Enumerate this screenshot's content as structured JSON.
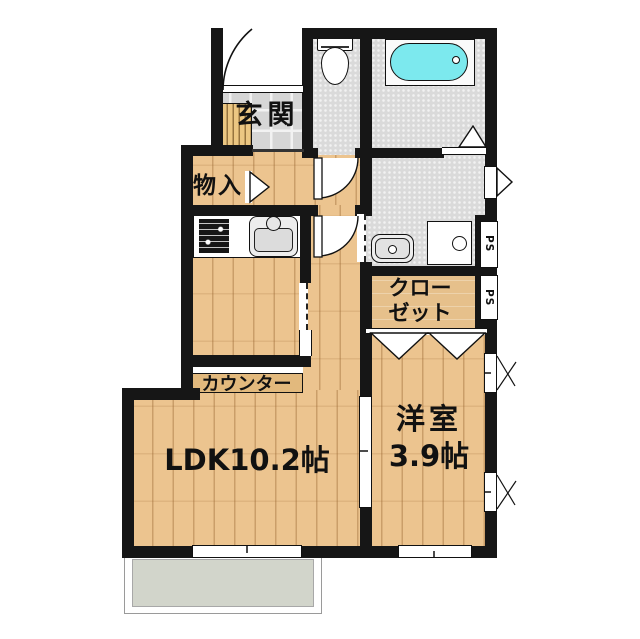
{
  "labels": {
    "genkan": "玄関",
    "monoire": "物入",
    "closet_line1": "クロー",
    "closet_line2": "ゼット",
    "ldk": "LDK10.2帖",
    "yoshitsu_line1": "洋室",
    "yoshitsu_line2": "3.9帖",
    "counter": "カウンター",
    "ps": "PS",
    "ps_right_top": "PS",
    "ps_right_bottom": "PS"
  },
  "rooms": [
    {
      "name": "LDK",
      "size": "10.2帖"
    },
    {
      "name": "洋室",
      "size": "3.9帖"
    },
    {
      "name": "玄関"
    },
    {
      "name": "物入"
    },
    {
      "name": "クローゼット"
    }
  ],
  "colors": {
    "wall": "#161616",
    "wood_floor": "#ecc48f",
    "tile_floor": "#d6d6d6",
    "wet_area_floor": "#dadada",
    "bathtub_water": "#7ce9ee",
    "balcony": "#d2d5cb",
    "counter_bar": "#e2b97d"
  },
  "icons": {
    "bathtub": "bathtub-icon",
    "toilet": "toilet-icon",
    "washbasin": "washbasin-icon",
    "washer_pan": "washing-machine-pan-icon",
    "stove": "stove-icon",
    "kitchen_sink": "kitchen-sink-icon",
    "shoe_cabinet": "shoe-cabinet-icon"
  }
}
